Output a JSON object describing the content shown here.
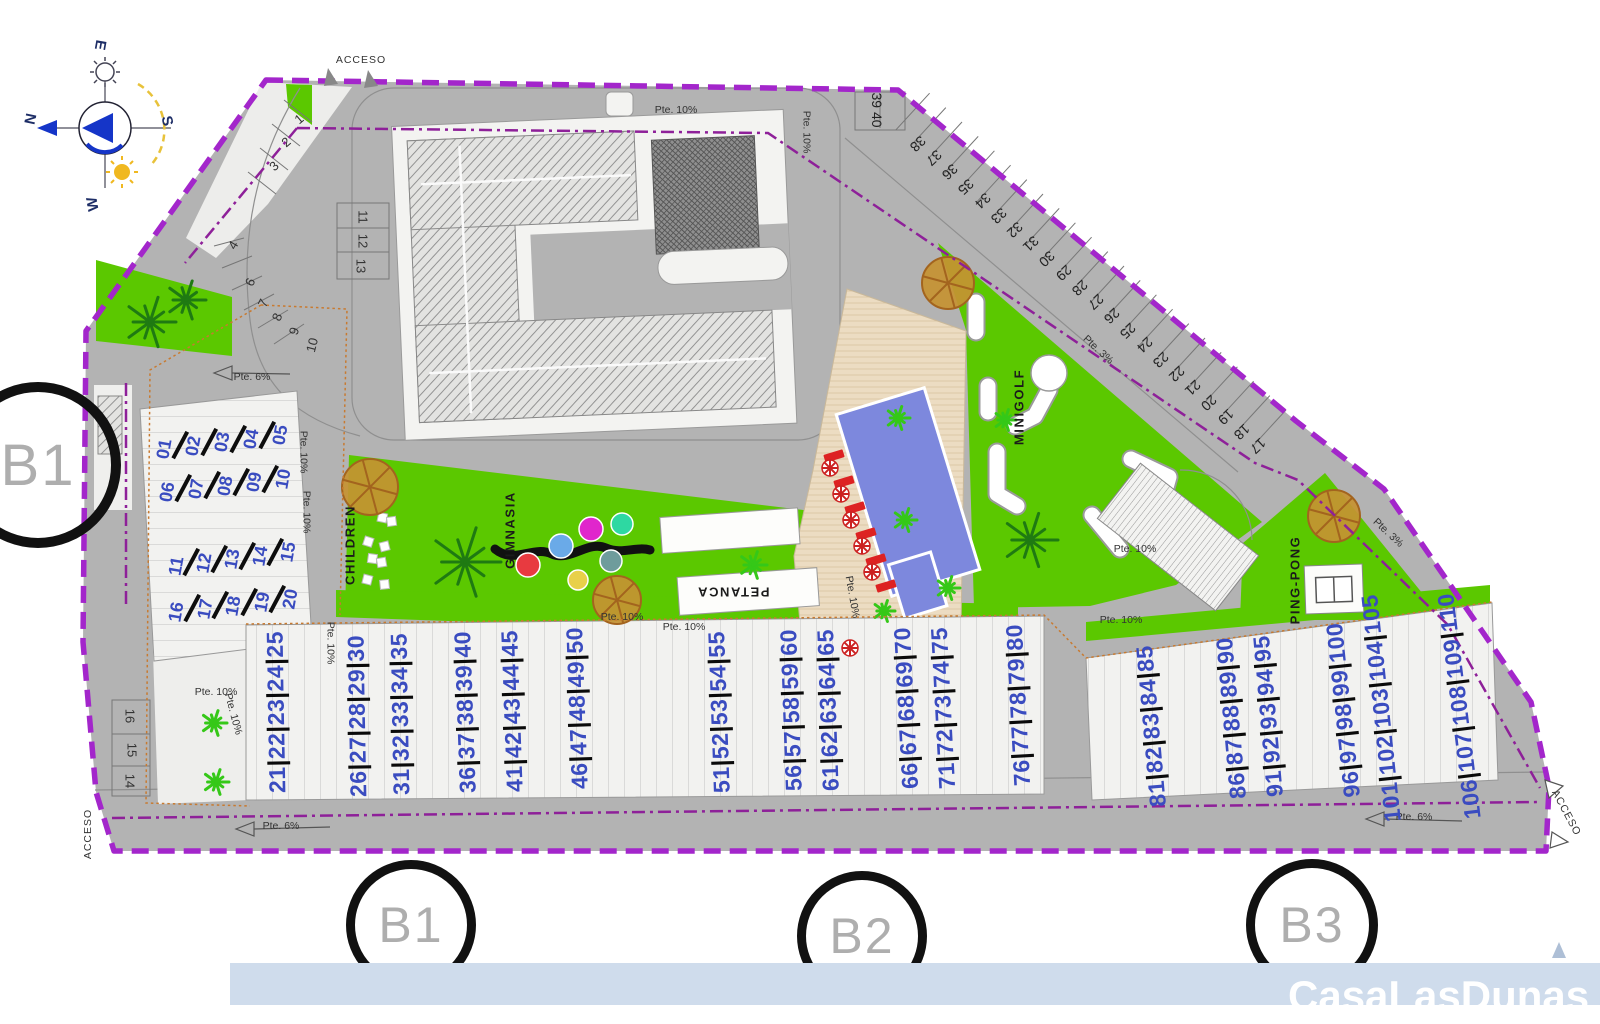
{
  "watermark": {
    "text": "CasaLasDunas"
  },
  "compass": {
    "n": "N",
    "e": "E",
    "s": "S",
    "w": "W"
  },
  "access": {
    "top": "ACCESO",
    "bottom_left": "ACCESO",
    "bottom_right": "ACCESO"
  },
  "block_markers": {
    "left": "B1",
    "b1": "B1",
    "b2": "B2",
    "b3": "B3"
  },
  "amenities": {
    "children": "CHILDREN",
    "gym": "GIMNASIA",
    "petanca": "PETANCA",
    "minigolf": "MINIGOLF",
    "pingpong": "PING-PONG"
  },
  "slopes": [
    {
      "text": "Pte. 10%",
      "x": 676,
      "y": 110,
      "rot": 0
    },
    {
      "text": "Pte. 10%",
      "x": 806,
      "y": 132,
      "rot": 90
    },
    {
      "text": "Pte. 10%",
      "x": 303,
      "y": 452,
      "rot": 90
    },
    {
      "text": "Pte. 10%",
      "x": 306,
      "y": 512,
      "rot": 90
    },
    {
      "text": "Pte. 10%",
      "x": 216,
      "y": 692,
      "rot": 0
    },
    {
      "text": "Pte. 10%",
      "x": 233,
      "y": 714,
      "rot": 75
    },
    {
      "text": "Pte. 10%",
      "x": 622,
      "y": 617,
      "rot": 0
    },
    {
      "text": "Pte. 10%",
      "x": 684,
      "y": 627,
      "rot": 0
    },
    {
      "text": "Pte. 10%",
      "x": 330,
      "y": 643,
      "rot": 90
    },
    {
      "text": "Pte. 10%",
      "x": 1121,
      "y": 620,
      "rot": 0
    },
    {
      "text": "Pte. 10%",
      "x": 852,
      "y": 597,
      "rot": 80
    },
    {
      "text": "Pte. 10%",
      "x": 1135,
      "y": 549,
      "rot": 0
    },
    {
      "text": "Pte. 6%",
      "x": 252,
      "y": 377,
      "rot": 0
    },
    {
      "text": "Pte. 6%",
      "x": 281,
      "y": 826,
      "rot": 0
    },
    {
      "text": "Pte. 6%",
      "x": 1414,
      "y": 817,
      "rot": 0
    },
    {
      "text": "Pte. 3%",
      "x": 1098,
      "y": 350,
      "rot": 43
    },
    {
      "text": "Pte. 3%",
      "x": 1388,
      "y": 533,
      "rot": 43
    }
  ],
  "parking": {
    "left_curve": [
      {
        "n": "1",
        "x": 299,
        "y": 119,
        "rot": -40
      },
      {
        "n": "2",
        "x": 286,
        "y": 142,
        "rot": -40
      },
      {
        "n": "3",
        "x": 274,
        "y": 166,
        "rot": -44
      },
      {
        "n": "4",
        "x": 233,
        "y": 245,
        "rot": -60
      },
      {
        "n": "6",
        "x": 250,
        "y": 282,
        "rot": -64
      },
      {
        "n": "7",
        "x": 263,
        "y": 303,
        "rot": -64
      },
      {
        "n": "8",
        "x": 277,
        "y": 317,
        "rot": -68
      },
      {
        "n": "9",
        "x": 294,
        "y": 331,
        "rot": -72
      },
      {
        "n": "10",
        "x": 312,
        "y": 345,
        "rot": -76
      }
    ],
    "middle_block": [
      {
        "n": "11",
        "x": 363,
        "y": 217,
        "rot": 90
      },
      {
        "n": "12",
        "x": 363,
        "y": 241,
        "rot": 90
      },
      {
        "n": "13",
        "x": 361,
        "y": 266,
        "rot": 90
      }
    ],
    "bottom_left_block": [
      {
        "n": "16",
        "x": 130,
        "y": 716,
        "rot": 90
      },
      {
        "n": "15",
        "x": 132,
        "y": 750,
        "rot": 90
      },
      {
        "n": "14",
        "x": 130,
        "y": 781,
        "rot": 90
      }
    ],
    "diagonal": {
      "numbers": [
        "17",
        "18",
        "19",
        "20",
        "21",
        "22",
        "23",
        "24",
        "25",
        "26",
        "27",
        "28",
        "29",
        "30",
        "31",
        "32",
        "33",
        "34",
        "35",
        "36",
        "37",
        "38"
      ],
      "x0": 1258,
      "y0": 446,
      "dx": -16.2,
      "dy": -14.4,
      "rot": 137
    },
    "pair": {
      "text": "39 40",
      "x": 877,
      "y": 110,
      "rot": 90
    }
  },
  "units": {
    "left_rows": [
      {
        "numbers": [
          "01",
          "02",
          "03",
          "04",
          "05"
        ],
        "x": 164,
        "y": 449,
        "dx": 29,
        "dy": -3.4
      },
      {
        "numbers": [
          "06",
          "07",
          "08",
          "09",
          "10"
        ],
        "x": 167,
        "y": 492,
        "dx": 29,
        "dy": -3.2
      },
      {
        "numbers": [
          "11",
          "12",
          "13",
          "14",
          "15"
        ],
        "x": 176,
        "y": 566,
        "dx": 28,
        "dy": -3.4
      },
      {
        "numbers": [
          "16",
          "17",
          "18",
          "19",
          "20"
        ],
        "x": 176,
        "y": 612,
        "dx": 28.5,
        "dy": -3.2
      }
    ],
    "bottom_columns": [
      {
        "numbers": [
          "21",
          "22",
          "23",
          "24",
          "25"
        ],
        "x": 277,
        "y": 712,
        "rot": -1
      },
      {
        "numbers": [
          "26",
          "27",
          "28",
          "29",
          "30"
        ],
        "x": 358,
        "y": 716,
        "rot": -1
      },
      {
        "numbers": [
          "31",
          "32",
          "33",
          "34",
          "35"
        ],
        "x": 401,
        "y": 714,
        "rot": -1
      },
      {
        "numbers": [
          "36",
          "37",
          "38",
          "39",
          "40"
        ],
        "x": 466,
        "y": 712,
        "rot": -2
      },
      {
        "numbers": [
          "41",
          "42",
          "43",
          "44",
          "45"
        ],
        "x": 513,
        "y": 711,
        "rot": -2
      },
      {
        "numbers": [
          "46",
          "47",
          "48",
          "49",
          "50"
        ],
        "x": 578,
        "y": 708,
        "rot": -2
      },
      {
        "numbers": [
          "51",
          "52",
          "53",
          "54",
          "55"
        ],
        "x": 720,
        "y": 712,
        "rot": -2
      },
      {
        "numbers": [
          "56",
          "57",
          "58",
          "59",
          "60"
        ],
        "x": 792,
        "y": 710,
        "rot": -2
      },
      {
        "numbers": [
          "61",
          "62",
          "63",
          "64",
          "65"
        ],
        "x": 829,
        "y": 710,
        "rot": -2
      },
      {
        "numbers": [
          "66",
          "67",
          "68",
          "69",
          "70"
        ],
        "x": 907,
        "y": 708,
        "rot": -3
      },
      {
        "numbers": [
          "71",
          "72",
          "73",
          "74",
          "75"
        ],
        "x": 944,
        "y": 708,
        "rot": -3
      },
      {
        "numbers": [
          "76",
          "77",
          "78",
          "79",
          "80"
        ],
        "x": 1019,
        "y": 705,
        "rot": -3
      },
      {
        "numbers": [
          "81",
          "82",
          "83",
          "84",
          "85"
        ],
        "x": 1152,
        "y": 726,
        "rot": -5
      },
      {
        "numbers": [
          "86",
          "87",
          "88",
          "89",
          "90"
        ],
        "x": 1232,
        "y": 718,
        "rot": -5
      },
      {
        "numbers": [
          "91",
          "92",
          "93",
          "94",
          "95"
        ],
        "x": 1269,
        "y": 716,
        "rot": -5
      },
      {
        "numbers": [
          "96",
          "97",
          "98",
          "99",
          "100"
        ],
        "x": 1344,
        "y": 710,
        "rot": -6
      },
      {
        "numbers": [
          "101",
          "102",
          "103",
          "104",
          "105"
        ],
        "x": 1382,
        "y": 708,
        "rot": -6
      },
      {
        "numbers": [
          "106",
          "107",
          "108",
          "109",
          "110"
        ],
        "x": 1460,
        "y": 706,
        "rot": -7
      }
    ]
  },
  "colors": {
    "boundary": "#a326cb",
    "inner_line": "#8e2099",
    "road": "#b3b3b3",
    "green": "#5bc800",
    "unit_number": "#3a4cc0",
    "pool": "#7d88dd",
    "deck": "#ecdcc2",
    "band": "#cfdcec",
    "lounger": "#dd2222",
    "tree": "#c59232",
    "gym_circles": [
      "#e83a40",
      "#6aaae8",
      "#e026cc",
      "#2ed8a2",
      "#e8d04a",
      "#6e9c9c"
    ]
  }
}
